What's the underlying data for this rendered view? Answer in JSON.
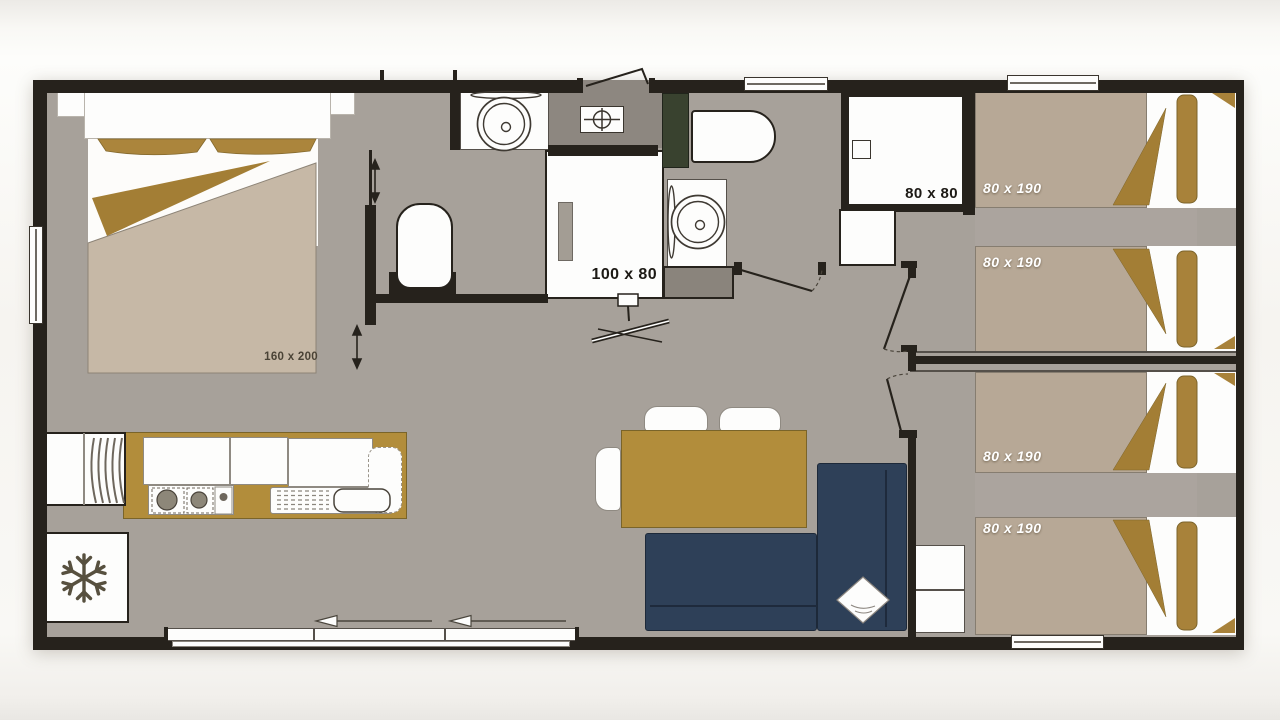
{
  "floor_plan": {
    "type": "mobile-home floor plan diagram",
    "labels": {
      "master_bed": "160 x 200",
      "bathroom_shower": "100 x 80",
      "shower_room": "80 x 80"
    },
    "twin_beds": [
      {
        "label": "80 x 190"
      },
      {
        "label": "80 x 190"
      },
      {
        "label": "80 x 190"
      },
      {
        "label": "80 x 190"
      }
    ],
    "icons": {
      "fridge": "snowflake-icon",
      "entry_ceiling_vent": "crosshair-vent-icon",
      "master_sliding_door": "double-arrow-icon",
      "patio_sliding_door": "slide-left-arrow-icon",
      "door_swings": "door-swing-arc-icon"
    },
    "colors": {
      "wall": "#26221c",
      "floor": "#a7a19a",
      "entry_floor": "#8d8780",
      "wood_accent": "#b28d3b",
      "bedding_tan": "#a8823a",
      "duvet_master": "#c6b8a6",
      "duvet_twin": "#b7a896",
      "sofa_navy": "#2e4058",
      "cabinet_green": "#39422f",
      "fixture_white": "#fdfdfc"
    }
  }
}
